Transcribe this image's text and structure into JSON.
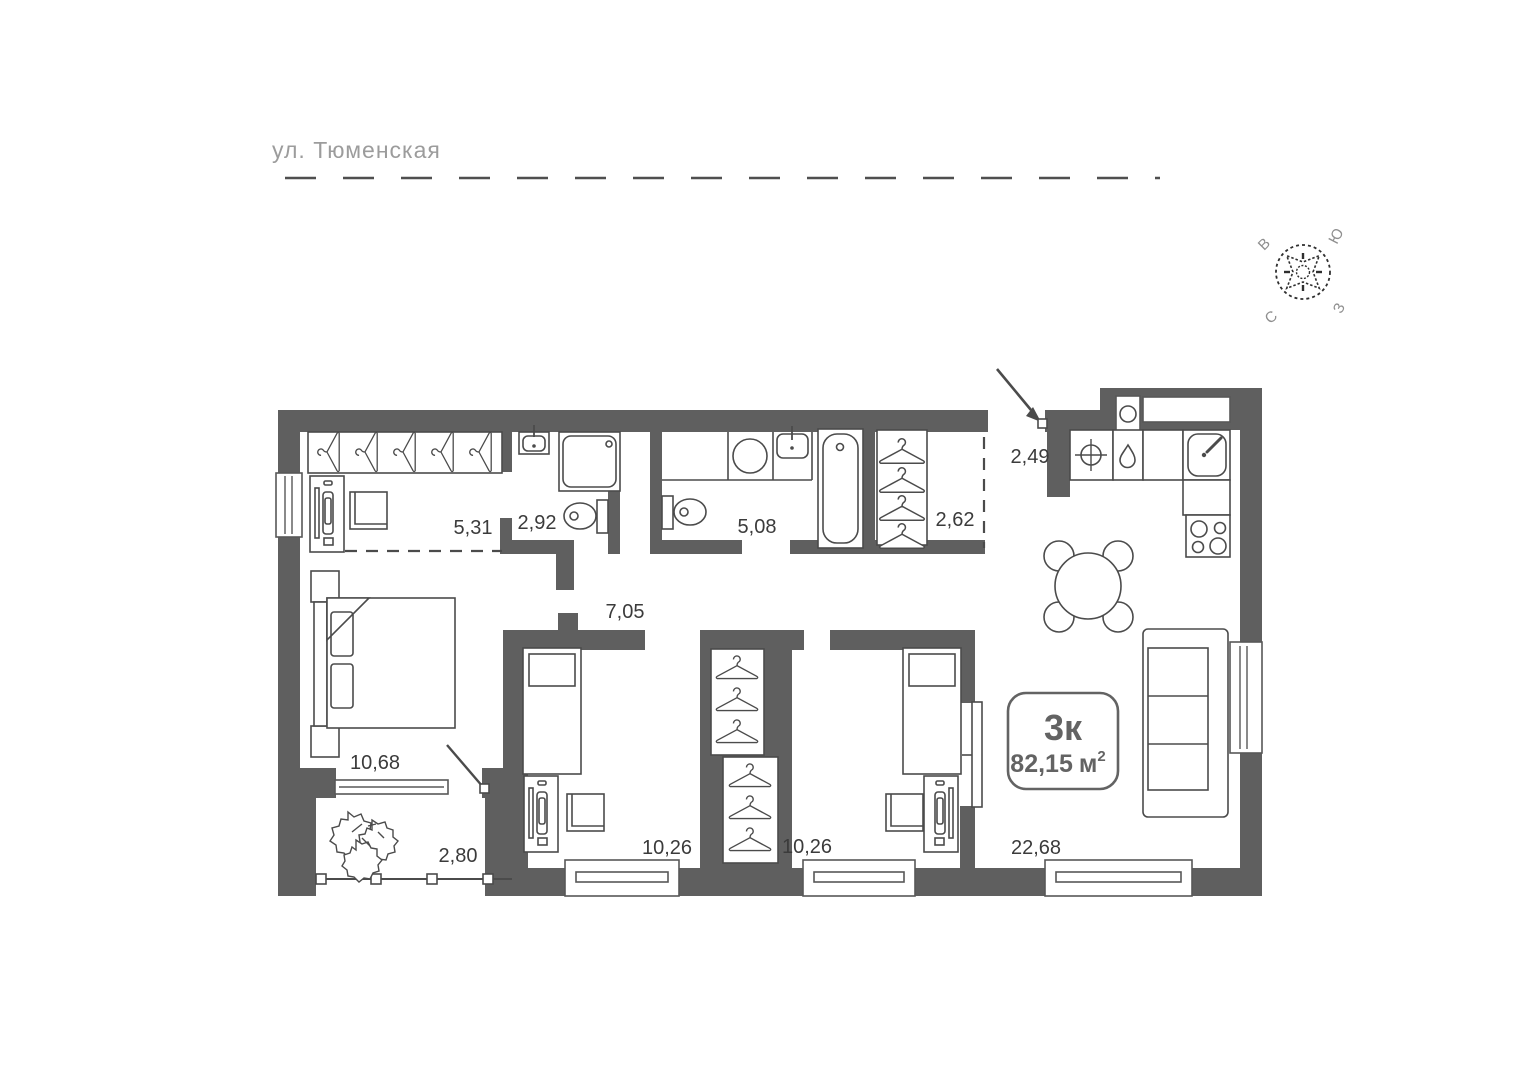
{
  "street": {
    "label": "ул. Тюменская"
  },
  "compass": {
    "east": "В",
    "south": "Ю",
    "north": "С",
    "west": "З"
  },
  "badge": {
    "type": "3к",
    "area": "82,15",
    "unit": "м",
    "sup": "2"
  },
  "rooms": [
    {
      "name": "wardrobe",
      "area": "5,31"
    },
    {
      "name": "shower-room",
      "area": "2,92"
    },
    {
      "name": "bathroom",
      "area": "5,08"
    },
    {
      "name": "closet",
      "area": "2,62"
    },
    {
      "name": "entry-hallway",
      "area": "2,49"
    },
    {
      "name": "corridor",
      "area": "7,05"
    },
    {
      "name": "bedroom-master",
      "area": "10,68"
    },
    {
      "name": "balcony",
      "area": "2,80"
    },
    {
      "name": "bedroom-middle",
      "area": "10,26"
    },
    {
      "name": "bedroom-right",
      "area": "10,26"
    },
    {
      "name": "kitchen-living-room",
      "area": "22,68"
    }
  ],
  "colors": {
    "wall": "#5f5f5f",
    "line": "#4b4b4b",
    "label": "#3b3b3b",
    "muted": "#9c9c9c"
  }
}
